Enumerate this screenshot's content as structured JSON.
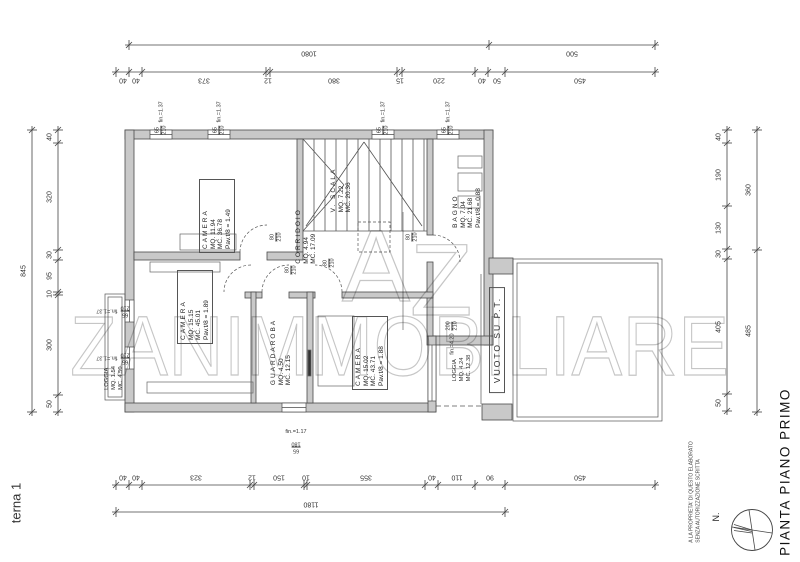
{
  "sheet": {
    "side_label": "terna 1",
    "title": "PIANTA PIANO PRIMO",
    "north": "N.",
    "disclaimer1": "A LA PROPRIETA' DI QUESTO ELABORATO",
    "disclaimer2": "SENZA AUTORIZZAZIONE SCRITTA"
  },
  "watermark": {
    "a": "A",
    "z": "Z",
    "name": "ZANIMMOBILIARE"
  },
  "rooms": {
    "camera1": {
      "name": "CAMERA",
      "mq": "MQ. 11.94",
      "mc": "MC. 36.78",
      "ratio": "Pav.t/8 = 1.49"
    },
    "scala": {
      "name": "V. SCALA",
      "mq": "MQ. 7.22",
      "mc": "MC. 20.36"
    },
    "corridoio": {
      "name": "CORRIDOIO",
      "mq": "MQ. 4.94",
      "mc": "MC. 17.09"
    },
    "bagno": {
      "name": "BAGNO",
      "mq": "MQ. 7.04",
      "mc": "MC. 21.68",
      "ratio": "Pav.t/8 = 0.88"
    },
    "camera2": {
      "name": "CAMERA",
      "mq": "MQ. 15.15",
      "mc": "MC. 45.01",
      "ratio": "Pav.t/8 = 1.89"
    },
    "guardaroba": {
      "name": "GUARDAROBA",
      "mq": "MQ. 4.50",
      "mc": "MC. 12.15"
    },
    "camera3": {
      "name": "CAMERA",
      "mq": "MQ. 15.02",
      "mc": "MC. 43.71",
      "ratio": "Pav.t/8 = 1.88"
    },
    "loggia_left": {
      "name": "LOGGIA",
      "mq": "MQ. 1.54",
      "mc": "MC. 4.50"
    },
    "loggia_right": {
      "name": "LOGGIA",
      "mq": "MQ. 4.24",
      "mc": "MC. 12.38"
    },
    "vuoto": {
      "name": "VUOTO SU P.T."
    }
  },
  "windows": {
    "w65x210": {
      "num": "65",
      "den": "210",
      "fin": "fin.=1.37"
    },
    "w65x180": {
      "num": "65",
      "den": "180",
      "fin": "fin.=1.17"
    },
    "w200x210": {
      "num": "200",
      "den": "210",
      "fin": "fin.=4.20"
    }
  },
  "door": {
    "num": "80",
    "den": "210"
  },
  "dimensions": {
    "top_overall": [
      "1080",
      "500"
    ],
    "top_segments": [
      "40",
      "40",
      "373",
      "12",
      "380",
      "15",
      "220",
      "40",
      "50",
      "450"
    ],
    "bottom_segments": [
      "40",
      "40",
      "323",
      "12",
      "150",
      "10",
      "355",
      "40",
      "110",
      "90",
      "450"
    ],
    "bottom_overall": [
      "1180"
    ],
    "left_overall": [
      "845"
    ],
    "left_segments": [
      "40",
      "320",
      "30",
      "95",
      "10",
      "300",
      "50"
    ],
    "right_segments": [
      "40",
      "190",
      "130",
      "30",
      "405",
      "50"
    ],
    "right_overall": [
      "360",
      "485"
    ]
  }
}
